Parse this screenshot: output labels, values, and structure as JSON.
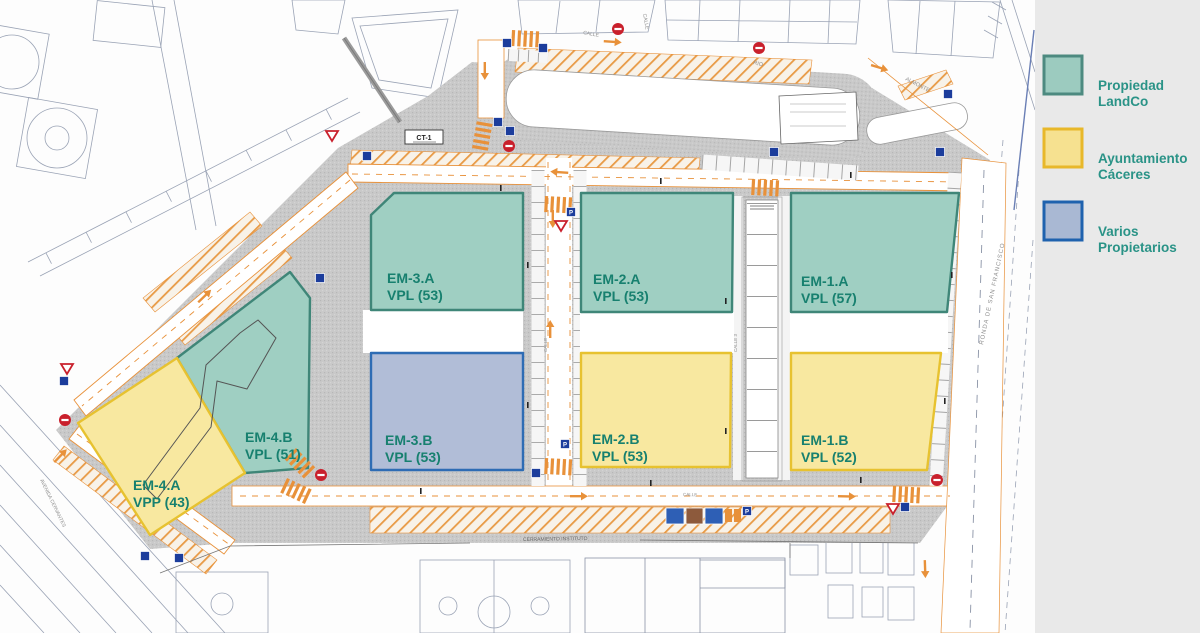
{
  "legend": {
    "items": [
      {
        "line1": "Propiedad",
        "line2": "LandCo",
        "fill": "#9ccbbf",
        "border": "#4d8a80"
      },
      {
        "line1": "Ayuntamiento",
        "line2": "Cáceres",
        "fill": "#f6e190",
        "border": "#e8b82a"
      },
      {
        "line1": "Varios",
        "line2": "Propietarios",
        "fill": "#a9b8d3",
        "border": "#1f62ae"
      }
    ]
  },
  "parcels": [
    {
      "name": "EM-3.A",
      "units": "VPL (53)",
      "owner": "Propiedad LandCo",
      "fill": "#9fcfc2",
      "border": "#3f8678"
    },
    {
      "name": "EM-3.B",
      "units": "VPL (53)",
      "owner": "Varios Propietarios",
      "fill": "#b1bdd7",
      "border": "#2e6cb4"
    },
    {
      "name": "EM-2.A",
      "units": "VPL (53)",
      "owner": "Propiedad LandCo",
      "fill": "#9fcfc2",
      "border": "#3f8678"
    },
    {
      "name": "EM-2.B",
      "units": "VPL (53)",
      "owner": "Ayuntamiento Cáceres",
      "fill": "#f8e8a0",
      "border": "#e7c230"
    },
    {
      "name": "EM-1.A",
      "units": "VPL (57)",
      "owner": "Propiedad LandCo",
      "fill": "#9fcfc2",
      "border": "#3f8678"
    },
    {
      "name": "EM-1.B",
      "units": "VPL (52)",
      "owner": "Ayuntamiento Cáceres",
      "fill": "#f8e8a0",
      "border": "#e7c230"
    },
    {
      "name": "EM-4.B",
      "units": "VPL (51)",
      "owner": "Propiedad LandCo",
      "fill": "#9fcfc2",
      "border": "#3f8678"
    },
    {
      "name": "EM-4.A",
      "units": "VPP (43)",
      "owner": "Ayuntamiento Cáceres",
      "fill": "#f8e8a0",
      "border": "#e7c230"
    }
  ],
  "streets": {
    "calle_top": "CALLE",
    "calle_top2": "CALLE",
    "rio": "RIO",
    "almonte": "ALMONTE",
    "calle_mid": "CALLE",
    "calle_3": "CALLE 3",
    "ronda": "RONDA DE SAN FRANCISCO",
    "calle_bottom": "CALLE",
    "avenida": "AVENIDA CERVANTES",
    "cerramiento": "CERRAMIENTO INSTITUTO",
    "ct1": "CT-1"
  }
}
